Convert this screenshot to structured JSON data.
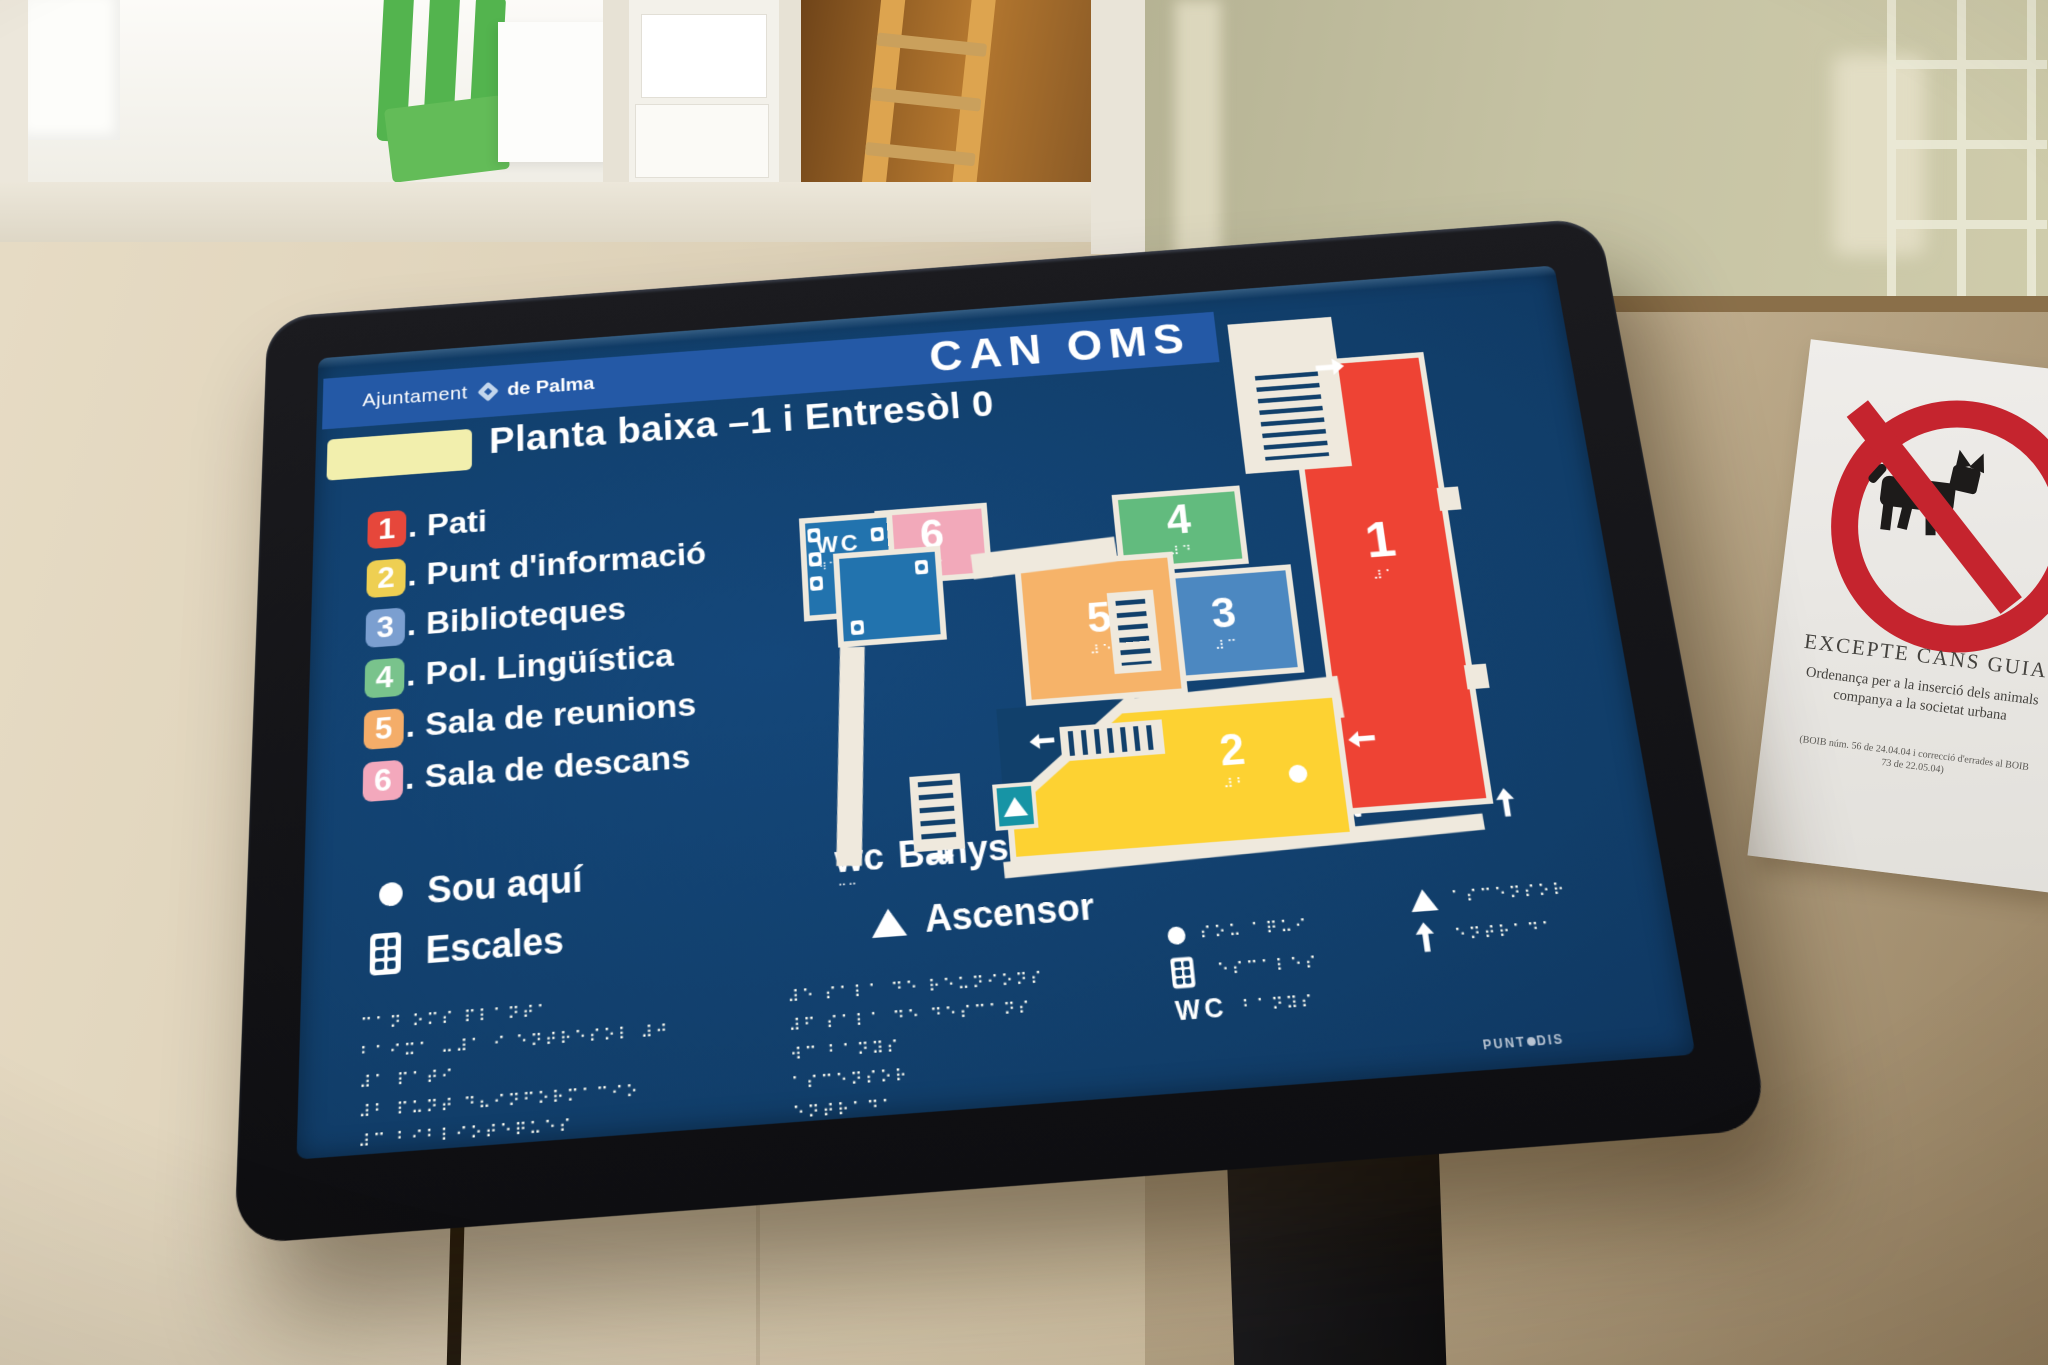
{
  "screen": {
    "brand": {
      "name": "Ajuntament",
      "place": "de Palma"
    },
    "title": "CAN OMS",
    "subtitle": "Planta baixa –1 i Entresòl 0",
    "legend_separator": ".",
    "legend": [
      {
        "num": "1",
        "label": "Pati",
        "color": "#e6473b"
      },
      {
        "num": "2",
        "label": "Punt d'informació",
        "color": "#eecf52"
      },
      {
        "num": "3",
        "label": "Biblioteques",
        "color": "#7b9fd0"
      },
      {
        "num": "4",
        "label": "Pol. Lingüística",
        "color": "#79c38c"
      },
      {
        "num": "5",
        "label": "Sala de reunions",
        "color": "#f4ad69"
      },
      {
        "num": "6",
        "label": "Sala de descans",
        "color": "#f3a8bc"
      }
    ],
    "symbols": {
      "sou_aqui": "Sou aquí",
      "escales": "Escales",
      "banys_prefix": "wc",
      "banys": "Banys",
      "ascensor": "Ascensor",
      "entrada": "Entrada"
    },
    "map": {
      "rooms": [
        {
          "num": "1",
          "braille": "⠼⠁",
          "color": "#ee4334"
        },
        {
          "num": "2",
          "braille": "⠼⠃",
          "color": "#fdd232"
        },
        {
          "num": "3",
          "braille": "⠼⠉",
          "color": "#4c88c1"
        },
        {
          "num": "4",
          "braille": "⠼⠙",
          "color": "#62bb7e"
        },
        {
          "num": "5",
          "braille": "⠼⠑",
          "color": "#f6b369"
        },
        {
          "num": "6",
          "braille": "⠼⠋",
          "color": "#f2a9ba"
        }
      ],
      "wc": {
        "label": "WC",
        "braille": "⠺⠉"
      }
    },
    "colors": {
      "screen_background": "#113e6a",
      "header_bar": "#2459a6",
      "floor_box": "#f2efad",
      "walls": "#efe9dd",
      "wc_room": "#2273ae",
      "lift": "#1794a5"
    },
    "braille": {
      "left": [
        "⠉⠁⠝ ⠕⠍⠎ ⠏⠇⠁⠝⠞⠁",
        "⠃⠁⠊⠭⠁ ⠤⠼⠁ ⠊ ⠑⠝⠞⠗⠑⠎⠕⠇ ⠼⠚",
        "⠼⠁ ⠏⠁⠞⠊",
        "⠼⠃ ⠏⠥⠝⠞ ⠙⠦⠊⠝⠋⠕⠗⠍⠁⠉⠊⠕",
        "⠼⠉ ⠃⠊⠃⠇⠊⠕⠞⠑⠟⠥⠑⠎",
        "⠼⠙ ⠏⠕⠇⠄ ⠇⠊⠝⠛⠥⠊⠎⠞⠊⠉⠁"
      ],
      "middle": [
        "⠼⠑ ⠎⠁⠇⠁ ⠙⠑ ⠗⠑⠥⠝⠊⠕⠝⠎",
        "⠼⠋ ⠎⠁⠇⠁ ⠙⠑ ⠙⠑⠎⠉⠁⠝⠎",
        "⠺⠉ ⠃⠁⠝⠽⠎",
        "⠁⠎⠉⠑⠝⠎⠕⠗",
        "⠑⠝⠞⠗⠁⠙⠁"
      ],
      "sou_aqui": "⠎⠕⠥ ⠁⠟⠥⠊",
      "escales": "⠑⠎⠉⠁⠇⠑⠎",
      "banys": "⠃⠁⠝⠽⠎",
      "banys_small": "⠒⠒",
      "ascensor": "⠁⠎⠉⠑⠝⠎⠕⠗",
      "entrada": "⠑⠝⠞⠗⠁⠙⠁"
    },
    "maker": {
      "part1": "PUNT",
      "part2": "DIS"
    }
  },
  "wall_sign": {
    "heading": "EXCEPTE CANS GUIA",
    "body_line1": "Ordenança per a la inserció dels animals",
    "body_line2": "companya a la societat urbana",
    "footnote_line1": "(BOIB núm. 56 de 24.04.04 i correcció d'errades al BOIB",
    "footnote_line2": "73 de 22.05.04)"
  }
}
